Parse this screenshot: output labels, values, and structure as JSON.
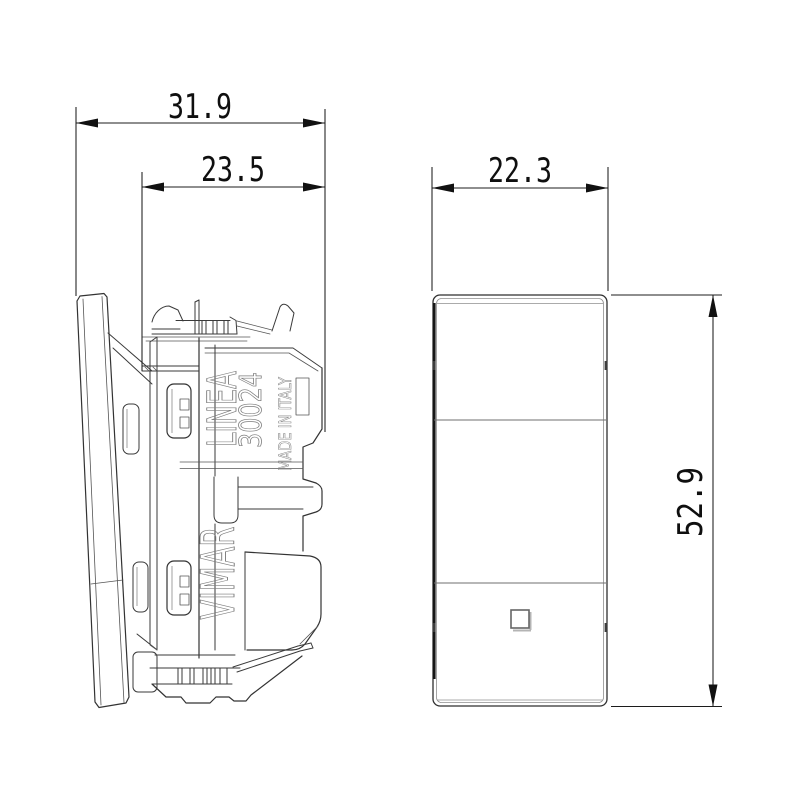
{
  "drawing": {
    "background": "#ffffff",
    "outline_color": "#3a3a3a",
    "dimension_color": "#1c1c1c",
    "dimensions": {
      "overall_depth_mm": "31.9",
      "mechanism_depth_mm": "23.5",
      "front_width_mm": "22.3",
      "front_height_mm": "52.9"
    },
    "side_view_markings": {
      "series": "LINEA",
      "model": "30024",
      "origin": "MADE IN ITALY",
      "brand": "VIMAR"
    }
  }
}
